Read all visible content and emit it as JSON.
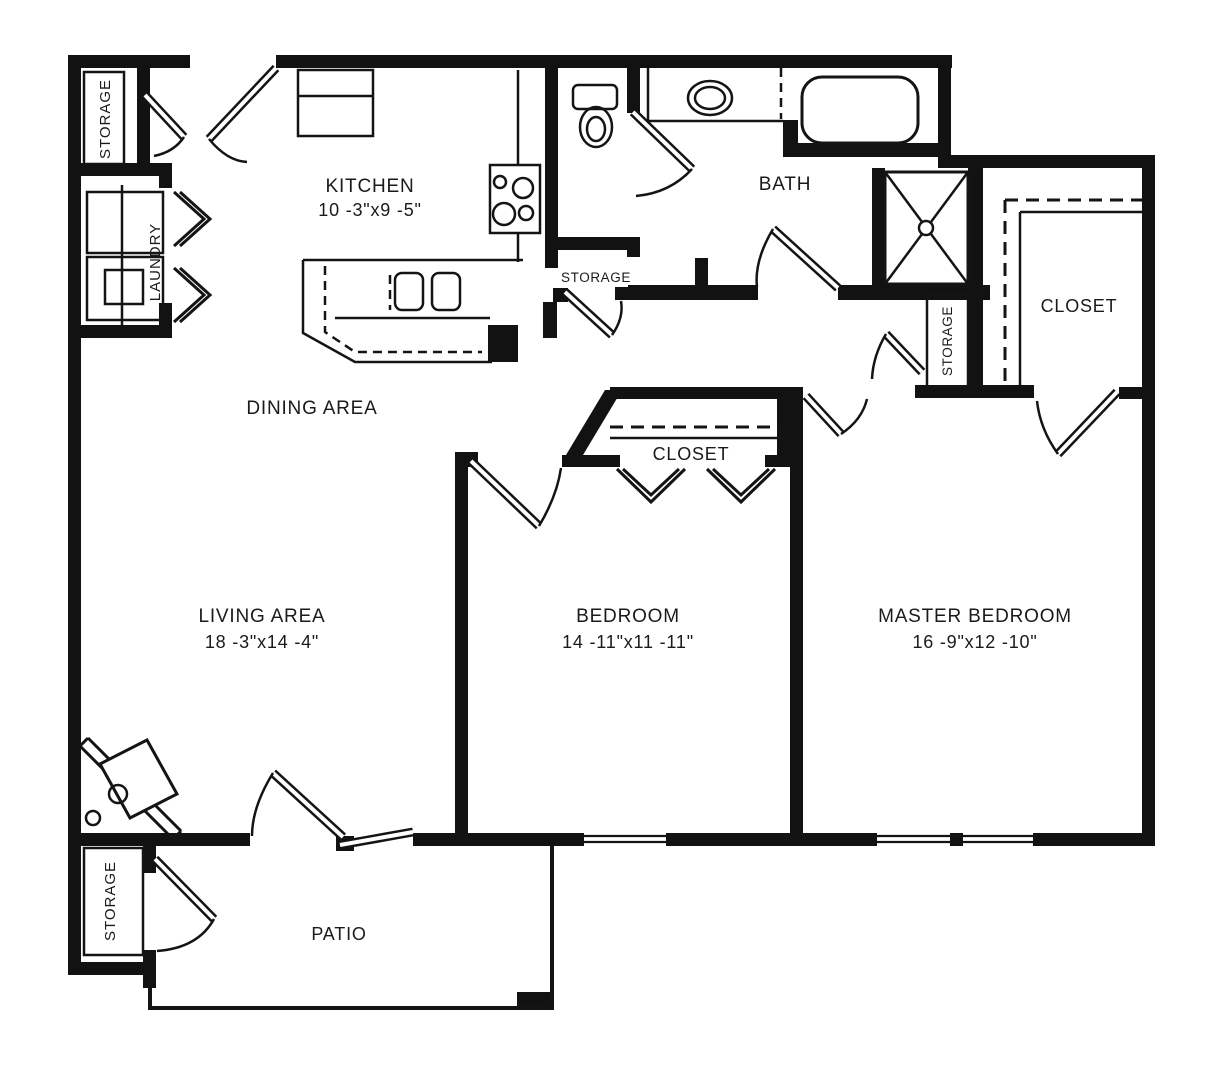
{
  "rooms": {
    "kitchen": {
      "name": "KITCHEN",
      "dims": "10 -3\"x9 -5\""
    },
    "dining_area": {
      "name": "DINING AREA"
    },
    "living_area": {
      "name": "LIVING AREA",
      "dims": "18 -3\"x14 -4\""
    },
    "bedroom": {
      "name": "BEDROOM",
      "dims": "14 -11\"x11 -11\""
    },
    "master_bedroom": {
      "name": "MASTER BEDROOM",
      "dims": "16 -9\"x12 -10\""
    },
    "bath": {
      "name": "BATH"
    },
    "patio": {
      "name": "PATIO"
    },
    "laundry": {
      "name": "LAUNDRY"
    },
    "closet_master": {
      "name": "CLOSET"
    },
    "closet_bedroom": {
      "name": "CLOSET"
    },
    "storage_entry": {
      "name": "STORAGE"
    },
    "storage_bath": {
      "name": "STORAGE"
    },
    "storage_master": {
      "name": "STORAGE"
    },
    "storage_patio": {
      "name": "STORAGE"
    }
  },
  "colors": {
    "line": "#121212",
    "background": "#ffffff"
  }
}
